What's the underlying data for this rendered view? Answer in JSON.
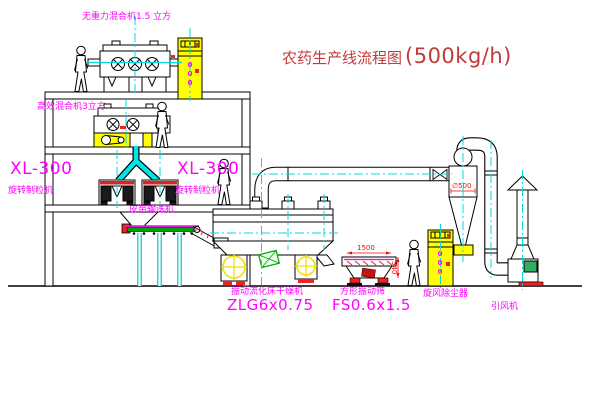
{
  "title": {
    "text": "农药生产线流程图",
    "capacity": "(500kg/h)"
  },
  "labels": {
    "mixer_top": "无重力混合机1.5 立方",
    "mixer_mid": "高效混合机3立方",
    "xl300_left": "XL-300",
    "granulator_left_name": "旋转制粒机",
    "xl300_right": "XL-300",
    "granulator_right_name": "旋转制粒机",
    "belt_conveyor": "皮带输送机",
    "dryer_name": "振动流化床干燥机",
    "dryer_model": "ZLG6x0.75",
    "sieve_name": "方形振动筛",
    "sieve_model": "FS0.6x1.5",
    "cyclone": "旋风除尘器",
    "fan": "引风机"
  },
  "dimensions": {
    "sieve_width": "1500",
    "sieve_height": "540",
    "cyclone_diameter": "∅500"
  },
  "elevators": {
    "elevator1_marking": "000",
    "elevator2_marking": "000"
  },
  "colors": {
    "centerline_cyan": "#00dcdc",
    "label_magenta": "#ff00ff",
    "dimension_red": "#ff0000",
    "title_red": "#c23b3b",
    "equipment_yellow": "#ffff00",
    "belt_green": "#00a400",
    "motor_green": "#2fae62",
    "accent_red": "#ee2222"
  }
}
